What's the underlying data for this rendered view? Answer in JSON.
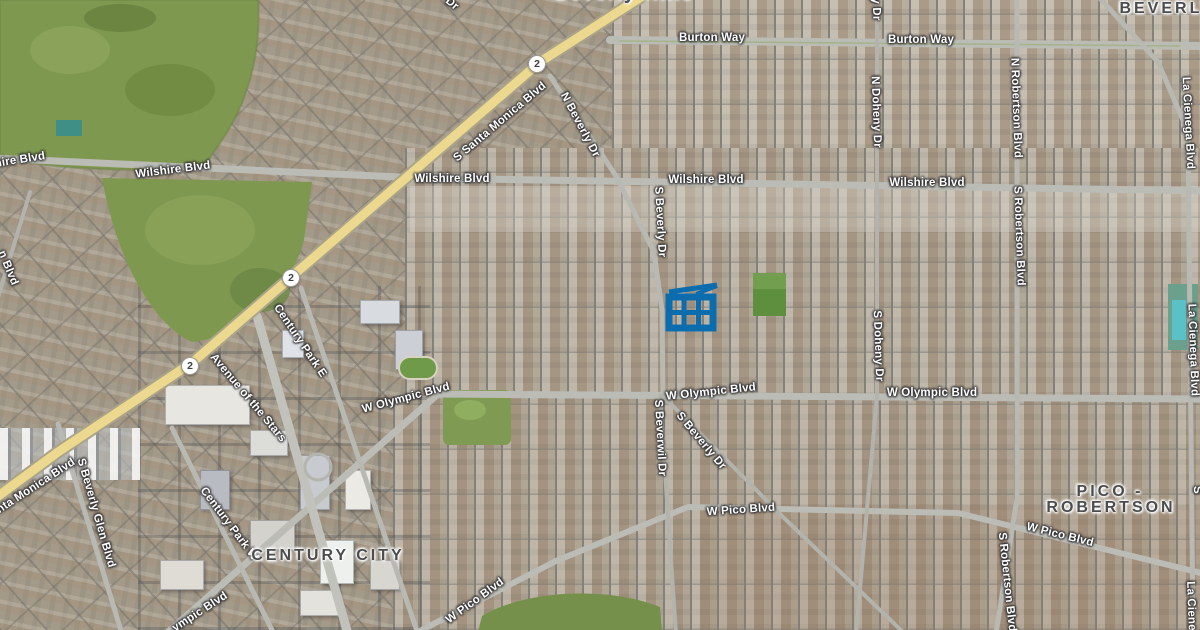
{
  "map": {
    "view_type": "satellite",
    "colors": {
      "selection_blue": "#0b6dad",
      "highway_yellow": "#ecd98f",
      "road_gray": "#bcbcb6",
      "area_label_gray": "#4a4c4e",
      "golf_green": "#7f9850"
    },
    "route_shields": [
      {
        "label": "2",
        "x": 537,
        "y": 64
      },
      {
        "label": "2",
        "x": 291,
        "y": 278
      },
      {
        "label": "2",
        "x": 190,
        "y": 366
      }
    ],
    "street_labels": [
      {
        "text": "hire Blvd",
        "x": 20,
        "y": 160,
        "rot": -9
      },
      {
        "text": "Wilshire Blvd",
        "x": 173,
        "y": 170,
        "rot": -7
      },
      {
        "text": "Wilshire Blvd",
        "x": 452,
        "y": 179,
        "rot": 0
      },
      {
        "text": "Wilshire Blvd",
        "x": 706,
        "y": 180,
        "rot": 0
      },
      {
        "text": "Wilshire Blvd",
        "x": 927,
        "y": 183,
        "rot": 0
      },
      {
        "text": "Burton Way",
        "x": 712,
        "y": 38,
        "rot": 0
      },
      {
        "text": "Burton Way",
        "x": 921,
        "y": 40,
        "rot": 0
      },
      {
        "text": "S Santa Monica Blvd",
        "x": 500,
        "y": 122,
        "rot": -40
      },
      {
        "text": "N Beverly Dr",
        "x": 580,
        "y": 125,
        "rot": 62
      },
      {
        "text": "S Beverly Dr",
        "x": 660,
        "y": 222,
        "rot": 87
      },
      {
        "text": "S Beverly Glen Blvd",
        "x": 96,
        "y": 513,
        "rot": 74
      },
      {
        "text": "nta Monica Blvd",
        "x": 36,
        "y": 486,
        "rot": -33
      },
      {
        "text": "n Blvd",
        "x": 8,
        "y": 268,
        "rot": 68
      },
      {
        "text": "Dr",
        "x": 452,
        "y": 4,
        "rot": 40
      },
      {
        "text": "Century Park E",
        "x": 300,
        "y": 341,
        "rot": 56
      },
      {
        "text": "Century Park W",
        "x": 229,
        "y": 524,
        "rot": 53
      },
      {
        "text": "Avenue of the Stars",
        "x": 248,
        "y": 398,
        "rot": 50
      },
      {
        "text": "W Olympic Blvd",
        "x": 406,
        "y": 398,
        "rot": -15
      },
      {
        "text": "W Olympic Blvd",
        "x": 711,
        "y": 392,
        "rot": -6
      },
      {
        "text": "W Olympic Blvd",
        "x": 932,
        "y": 393,
        "rot": 0
      },
      {
        "text": "ympic Blvd",
        "x": 200,
        "y": 612,
        "rot": -33
      },
      {
        "text": "S Beverwil Dr",
        "x": 660,
        "y": 438,
        "rot": 87
      },
      {
        "text": "S Beverly Dr",
        "x": 701,
        "y": 441,
        "rot": 50
      },
      {
        "text": "W Pico Blvd",
        "x": 741,
        "y": 510,
        "rot": -4
      },
      {
        "text": "W Pico Blvd",
        "x": 1060,
        "y": 535,
        "rot": 14
      },
      {
        "text": "W Pico Blvd",
        "x": 475,
        "y": 601,
        "rot": -36
      },
      {
        "text": "N Doheny Dr",
        "x": 876,
        "y": 112,
        "rot": 88
      },
      {
        "text": "y Dr",
        "x": 876,
        "y": 9,
        "rot": 88
      },
      {
        "text": "S Doheny Dr",
        "x": 878,
        "y": 346,
        "rot": 88
      },
      {
        "text": "N Robertson Blvd",
        "x": 1016,
        "y": 108,
        "rot": 88
      },
      {
        "text": "S Robertson Blvd",
        "x": 1019,
        "y": 236,
        "rot": 88
      },
      {
        "text": "S Robertson Blvd",
        "x": 1007,
        "y": 582,
        "rot": 84
      },
      {
        "text": "La Cienega Blvd",
        "x": 1188,
        "y": 123,
        "rot": 87
      },
      {
        "text": "La Cienega Blvd",
        "x": 1193,
        "y": 350,
        "rot": 88
      },
      {
        "text": "La Ciene",
        "x": 1191,
        "y": 606,
        "rot": 88
      },
      {
        "text": "S",
        "x": 1197,
        "y": 490,
        "rot": 88
      }
    ],
    "area_labels": [
      {
        "text": "CENTURY CITY",
        "x": 328,
        "y": 556
      },
      {
        "text": "PICO -",
        "x": 1110,
        "y": 492
      },
      {
        "text": "ROBERTSON",
        "x": 1111,
        "y": 508
      },
      {
        "text": "BEVERLY",
        "x": 1167,
        "y": 9
      }
    ],
    "city_labels": [
      {
        "text": "Beverly Hills",
        "x": 624,
        "y": -6
      }
    ],
    "selected_building": {
      "icon": "building-footprint-icon",
      "color": "#0b6dad",
      "x": 660,
      "y": 278
    }
  }
}
